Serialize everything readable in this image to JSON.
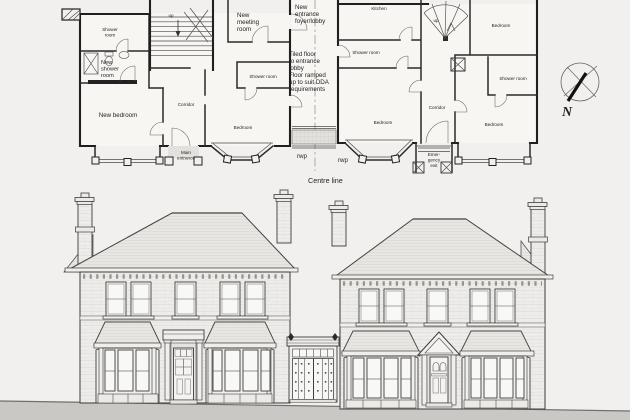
{
  "drawing": {
    "type": "architectural plan and front elevation",
    "colors": {
      "paper": "#f1f0ee",
      "ink": "#1f1f1f",
      "ground_band": "#c9c8c5",
      "facade_fill": "#edecea",
      "roof_fill": "#e8e6e2"
    }
  },
  "plan": {
    "labels": {
      "up_left": "up",
      "shower_room_top_left": [
        "Shower",
        "room"
      ],
      "new_shower_room": [
        "New",
        "shower",
        "room"
      ],
      "new_bedroom": "New bedroom",
      "corridor_left": "Corridor",
      "main_entrance": [
        "Main",
        "entrance"
      ],
      "new_meeting_room": [
        "New",
        "meeting",
        "room"
      ],
      "new_entrance_foyer": [
        "New",
        "entrance",
        "foyer/lobby"
      ],
      "shower_room_left_inner": "Shower room",
      "bedroom_left": "Bedroom",
      "tiled_note": [
        "Tiled floor",
        "to entrance",
        "lobby",
        "Floor ramped",
        "up to suit DDA",
        "requirements"
      ],
      "kitchen": "Kitchen",
      "up_right": "up",
      "shower_room_right_inner": "Shower room",
      "bedroom_right_front": "Bedroom",
      "corridor_right": "Corridor",
      "emergency_exit": [
        "Emer-",
        "gency",
        "exit"
      ],
      "bedroom_top_right": "Bedroom",
      "shower_room_far_right": "Shower room",
      "bedroom_far_right": "Bedroom",
      "rwp_left": "rwp",
      "rwp_right": "rwp",
      "centre_line": "Centre line",
      "north": "N"
    }
  },
  "elevation": {
    "description": "Front elevation of two brick houses joined by a new single-storey glazed entrance link"
  }
}
